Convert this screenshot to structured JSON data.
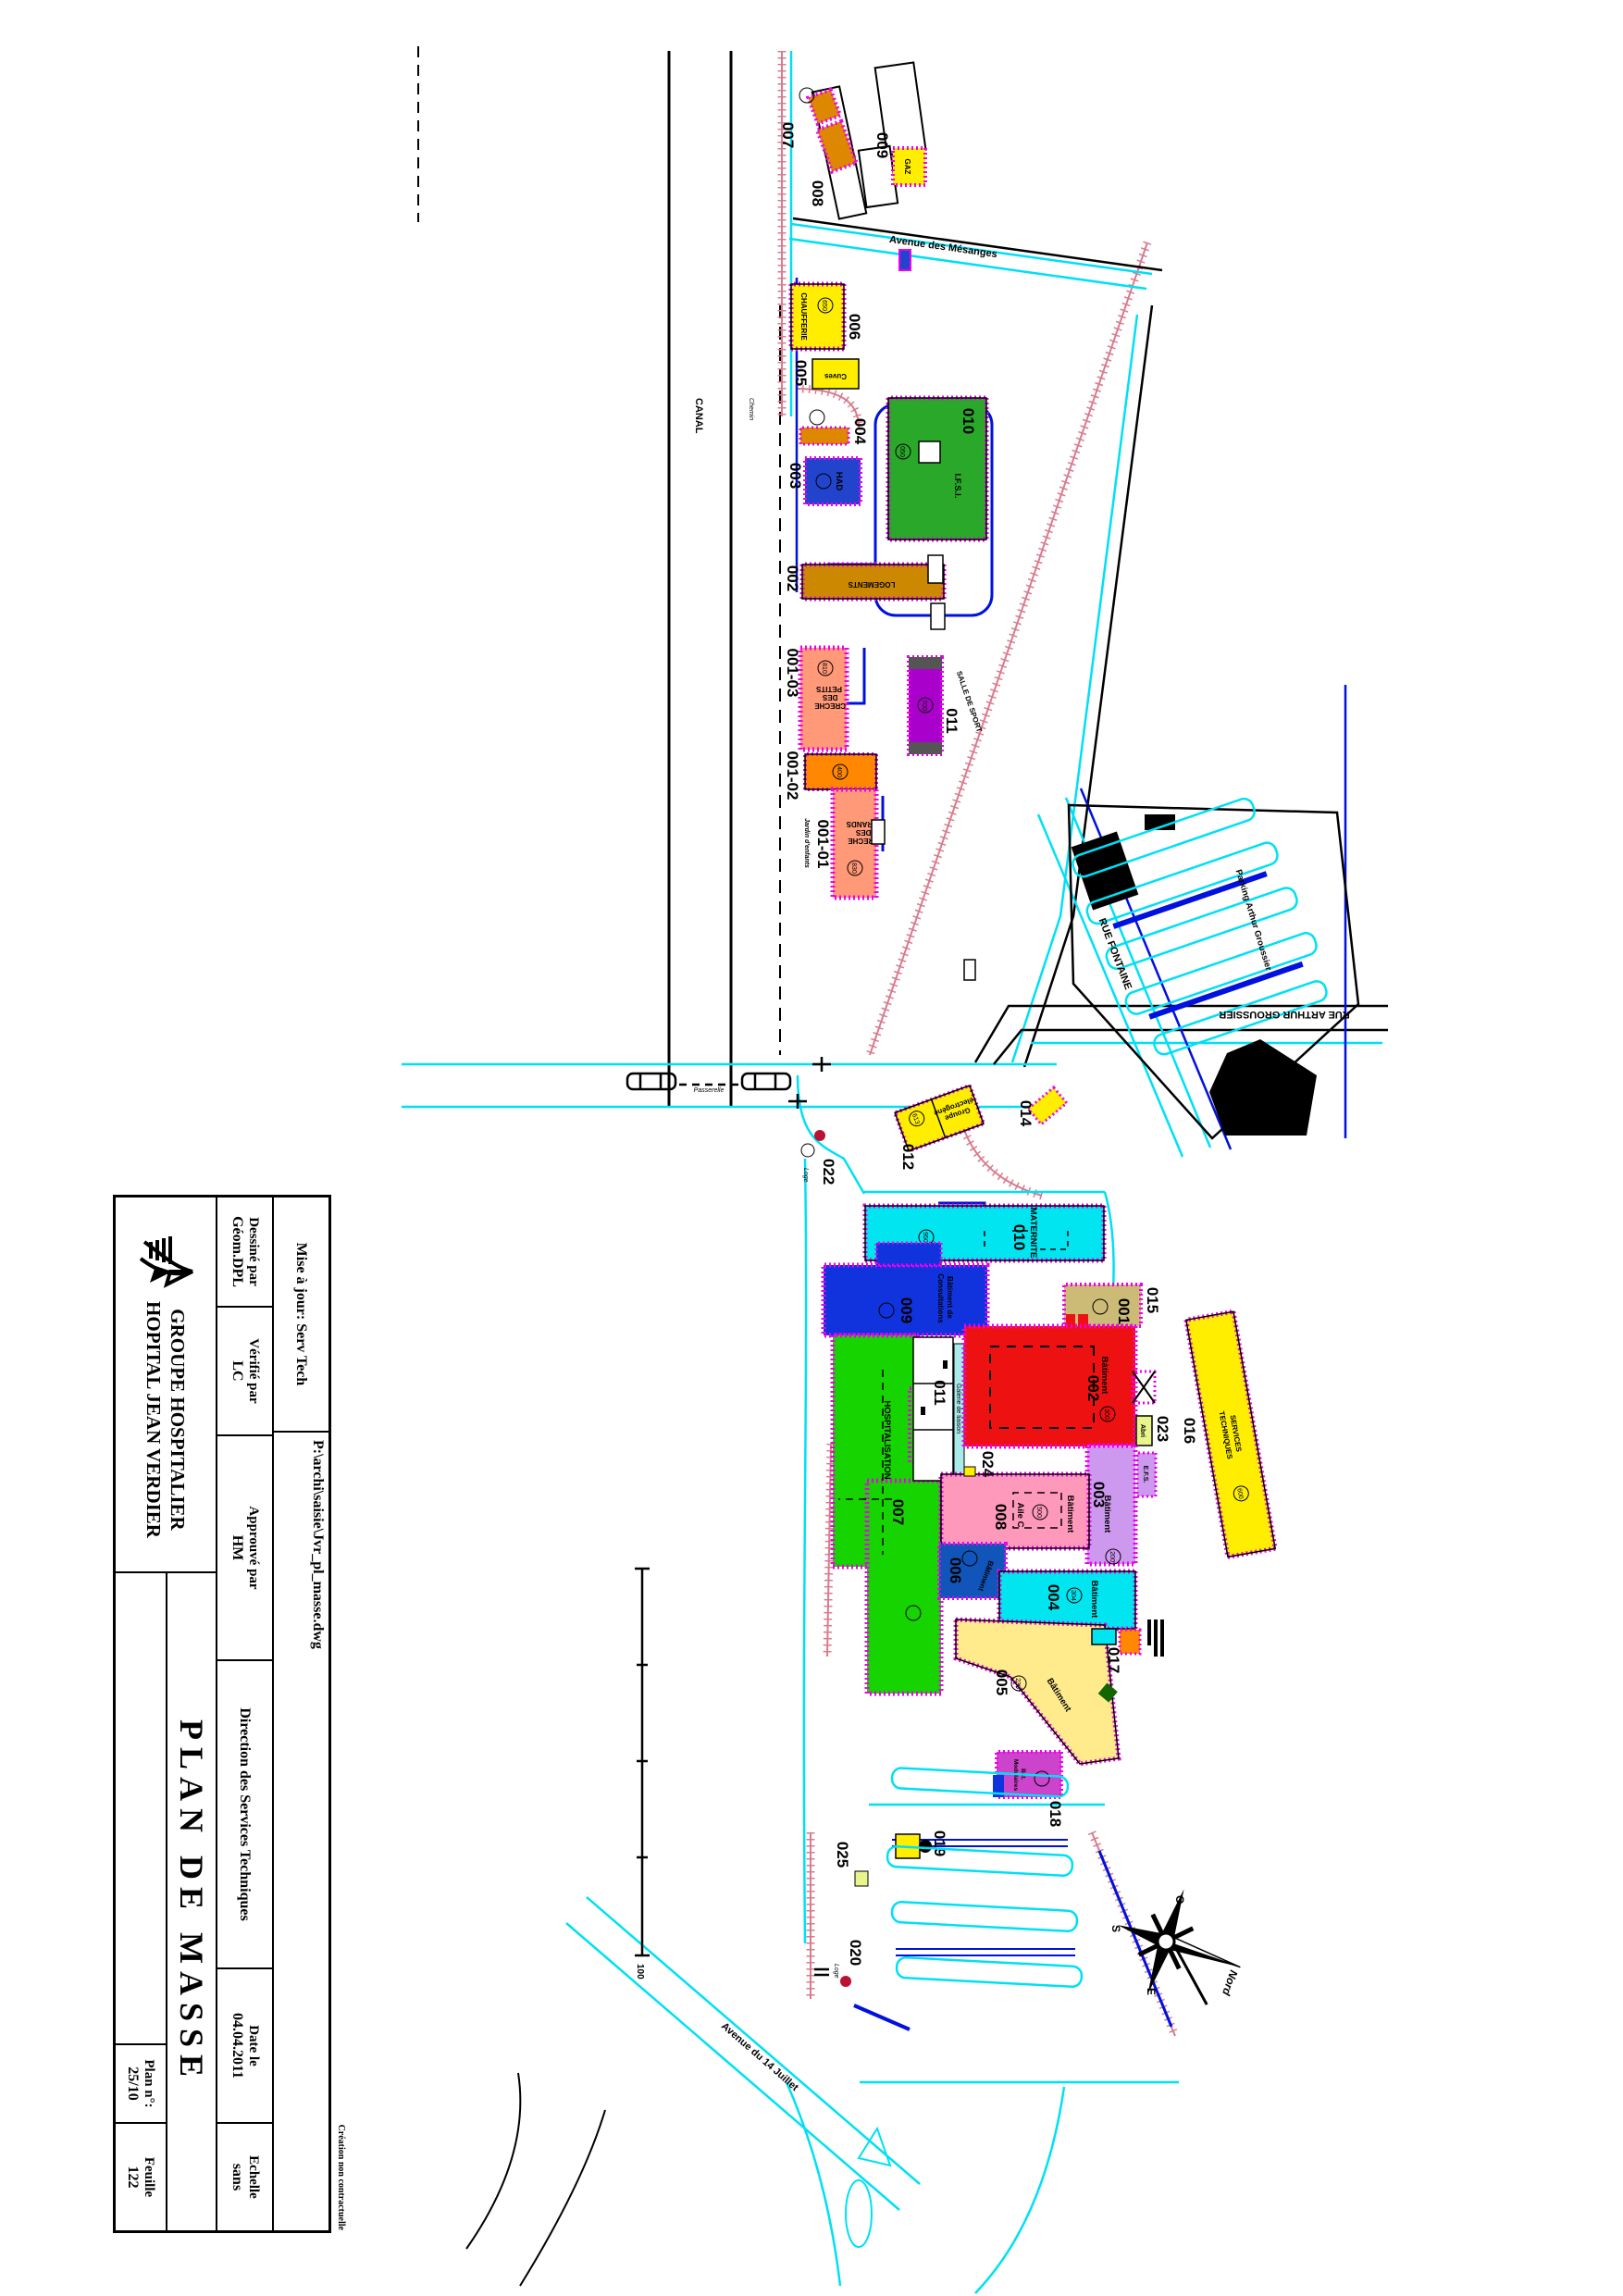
{
  "title_block": {
    "mise_a_jour": "Mise à jour: Serv Tech",
    "file_path": "P:\\archi\\saisie\\Jvr_pl_masse.dwg",
    "dessine_label": "Dessiné par",
    "dessine_value": "Géom.DPL",
    "verifie_label": "Vérifié par",
    "verifie_value": "LC",
    "approuve_label": "Approuvé par",
    "approuve_value": "HM",
    "direction": "Direction des Services Techniques",
    "date_label": "Date le",
    "date_value": "04.04.2011",
    "echelle_label": "Echelle",
    "echelle_value": "sans",
    "org_line1": "GROUPE HOSPITALIER",
    "org_line2": "HOPITAL JEAN VERDIER",
    "title": "PLAN DE MASSE",
    "plan_label": "Plan n°:",
    "plan_value": "25/10",
    "feuille_label": "Feuille",
    "feuille_value": "122",
    "disclaimer": "Création non contractuelle"
  },
  "map": {
    "streets": {
      "mesanges": "Avenue des Mésanges",
      "fontaine": "RUE FONTAINE",
      "groussier": "RUE ARTHUR GROUSSIER",
      "parking_groussier": "Parking Arthur Groussier",
      "av14": "Avenue du 14 Juillet",
      "salle_sport": "SALLE DE SPORT",
      "canal": "CANAL",
      "chemin": "Chemin",
      "passerelle": "Passerelle"
    },
    "nums": {
      "n001": "001",
      "n001_01": "001-01",
      "n001_02": "001-02",
      "n001_03": "001-03",
      "n002": "002",
      "n003": "003",
      "n004": "004",
      "n005": "005",
      "n006": "006",
      "n007": "007",
      "n008": "008",
      "n009": "009",
      "n010": "010",
      "n011": "011",
      "n012": "012",
      "n014": "014",
      "n015": "015",
      "n016": "016",
      "n017": "017",
      "n018": "018",
      "n019": "019",
      "n020": "020",
      "n022": "022",
      "n023": "023",
      "n024": "024",
      "n025": "025"
    },
    "names": {
      "chaufferie": "CHAUFFERIE",
      "cuves": "Cuves",
      "gaz": "GAZ",
      "had": "HAD",
      "ifsi": "I.F.S.I.",
      "logements": "LOGEMENTS",
      "creche_petits": [
        "CRECHE",
        "DES",
        "PETITS"
      ],
      "creche_grands": [
        "CRECHE",
        "DES",
        "GRANDS"
      ],
      "jardin": "Jardin d'enfants",
      "maternite": "MATERNITE",
      "consultations": [
        "Bâtiment de",
        "Consultations"
      ],
      "hospitalisation": "HOSPITALISATION",
      "batiment": "Bâtiment",
      "aile_c": "Aile C",
      "galerie": "Galerie de liaison",
      "efs": "E.F.S.",
      "abri": "Abri",
      "services": [
        "SERVICES",
        "TECHNIQUES"
      ],
      "groupe_elec": [
        "Groupe",
        "électrogène"
      ],
      "modulaires": [
        "Bât.",
        "Modulaires"
      ],
      "loge": "Loge"
    },
    "refs": {
      "r050": "050",
      "r200": "200",
      "r230": "230",
      "r300": "300",
      "r304": "304",
      "r400": "400",
      "r500": "500",
      "r600": "600",
      "r613": "613",
      "r650": "650",
      "r700": "700",
      "r810": "810",
      "r830": "830",
      "r950": "950"
    },
    "compass": {
      "nord": "Nord",
      "s": "S",
      "e": "E",
      "o": "O"
    },
    "scale_end": "100"
  }
}
